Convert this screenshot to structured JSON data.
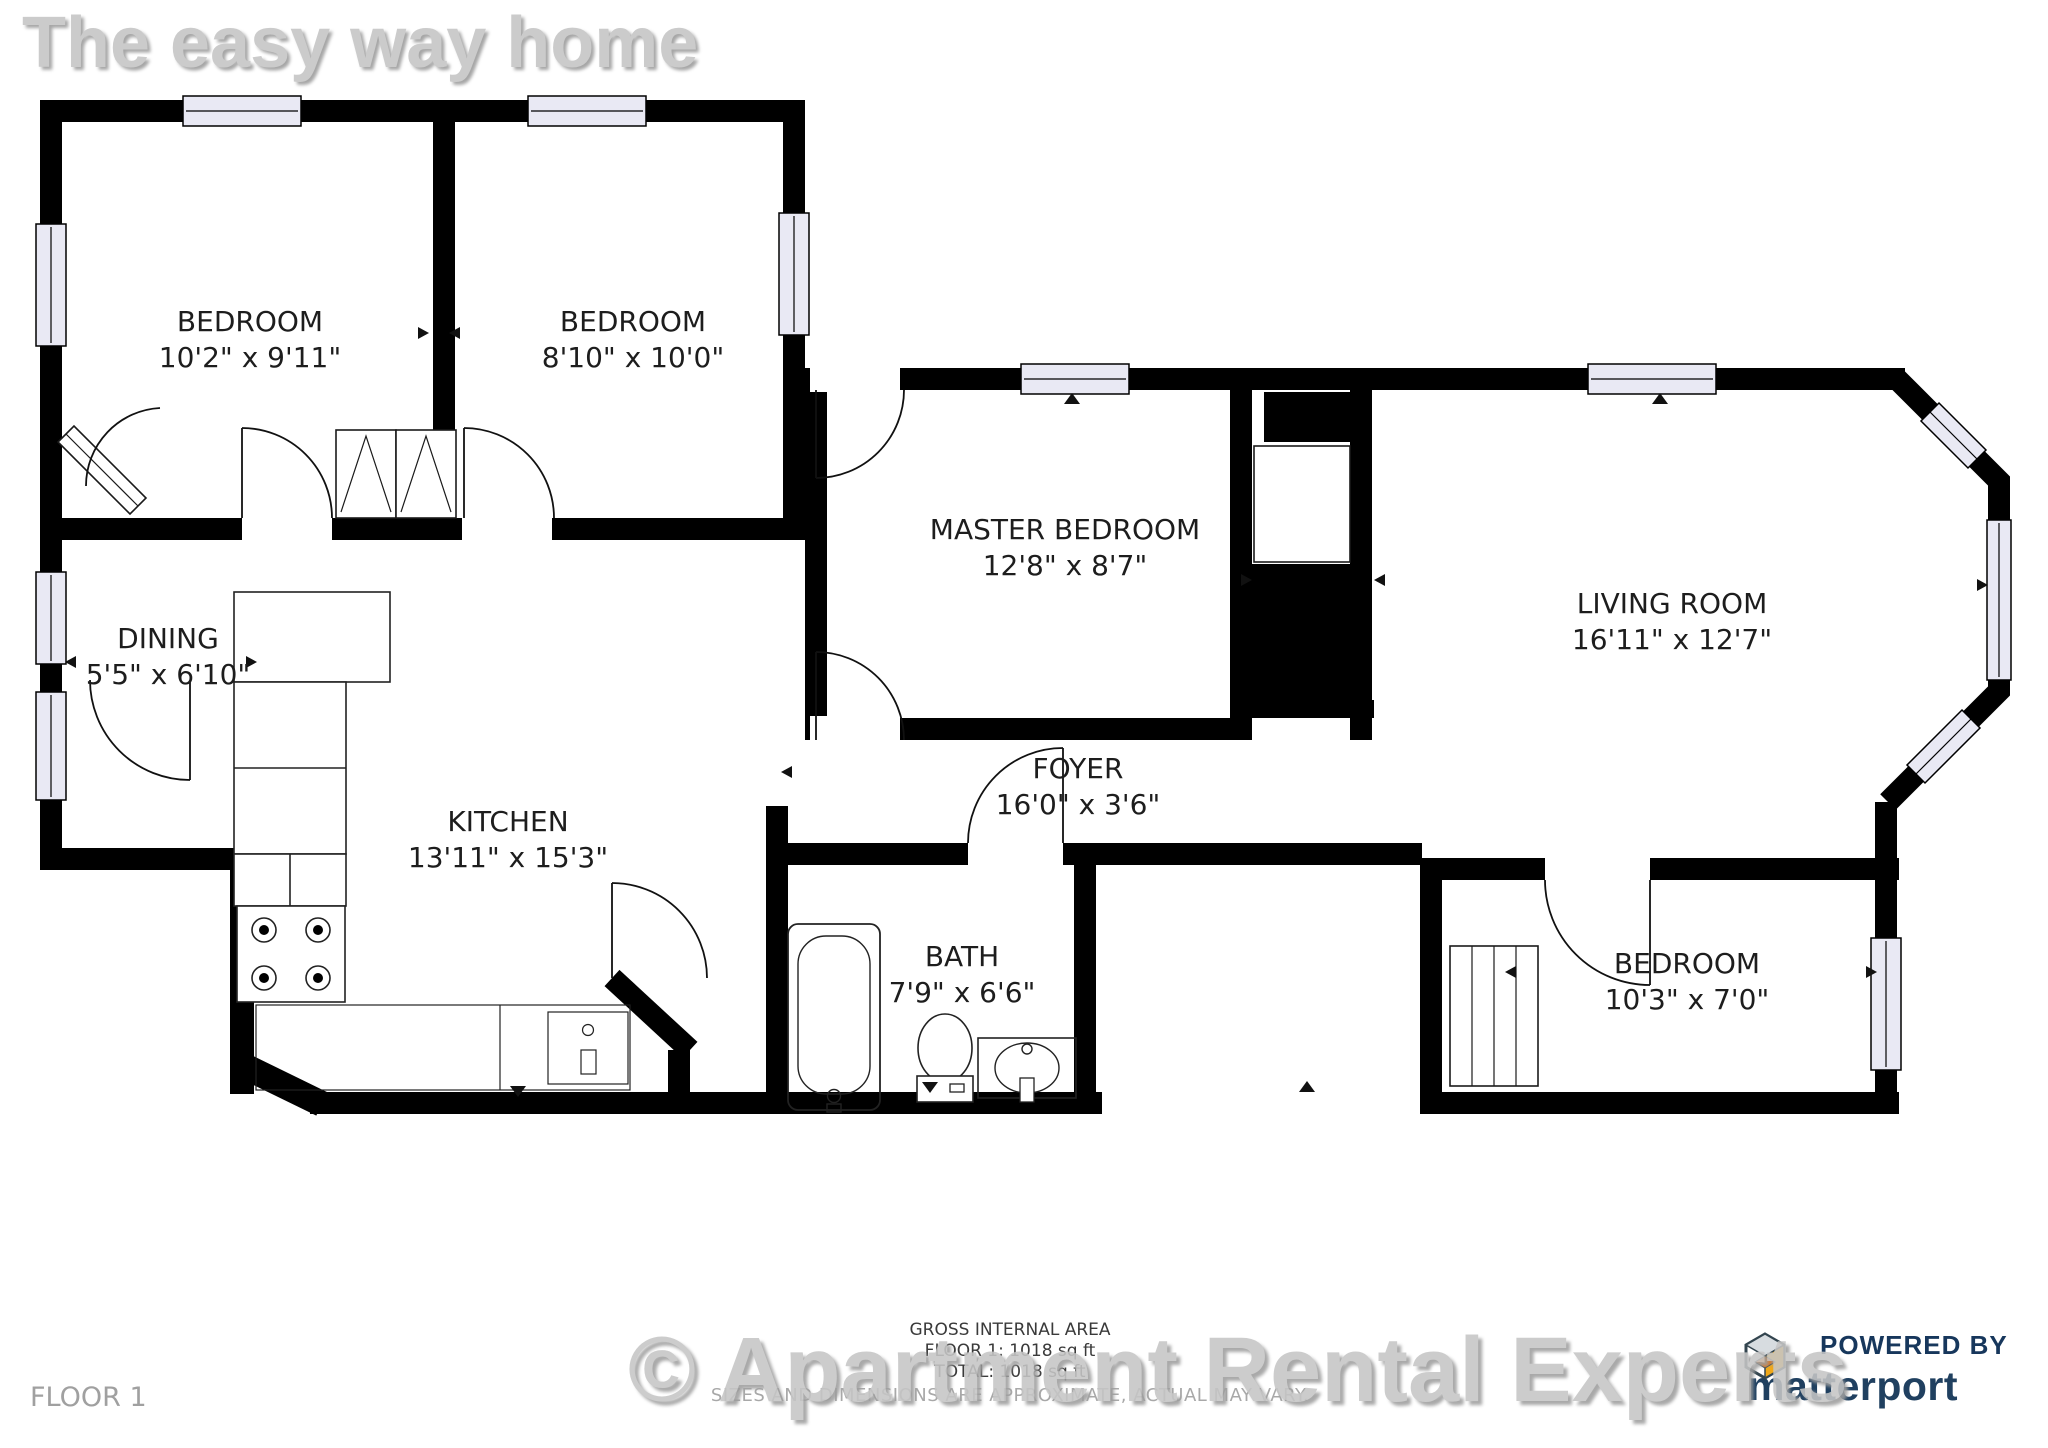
{
  "watermarks": {
    "top": "The easy way home",
    "bottom": "© Apartment Rental Experts"
  },
  "rooms": {
    "b1": {
      "name": "BEDROOM",
      "dims": "10'2\" x 9'11\""
    },
    "b2": {
      "name": "BEDROOM",
      "dims": "8'10\" x 10'0\""
    },
    "master": {
      "name": "MASTER BEDROOM",
      "dims": "12'8\" x 8'7\""
    },
    "living": {
      "name": "LIVING ROOM",
      "dims": "16'11\" x 12'7\""
    },
    "dining": {
      "name": "DINING",
      "dims": "5'5\" x 6'10\""
    },
    "kitchen": {
      "name": "KITCHEN",
      "dims": "13'11\" x 15'3\""
    },
    "foyer": {
      "name": "FOYER",
      "dims": "16'0\" x 3'6\""
    },
    "bath": {
      "name": "BATH",
      "dims": "7'9\" x 6'6\""
    },
    "b3": {
      "name": "BEDROOM",
      "dims": "10'3\" x 7'0\""
    }
  },
  "footer": {
    "gross_area_label": "GROSS INTERNAL AREA",
    "floor_area": "FLOOR 1: 1018 sq ft",
    "total_area": "TOTAL: 1018 sq ft",
    "disclaimer": "SIZES AND DIMENSIONS ARE APPROXIMATE, ACTUAL MAY VARY.",
    "floor_label": "FLOOR 1"
  },
  "branding": {
    "powered_by": "POWERED BY",
    "brand": "matterport"
  },
  "colors": {
    "wall": "#000000",
    "window_fill": "#e9e9f4",
    "watermark_gray": "#c6c6c6",
    "brand_navy": "#204060",
    "accent_yellow": "#f0a818",
    "accent_orange": "#e07010"
  }
}
